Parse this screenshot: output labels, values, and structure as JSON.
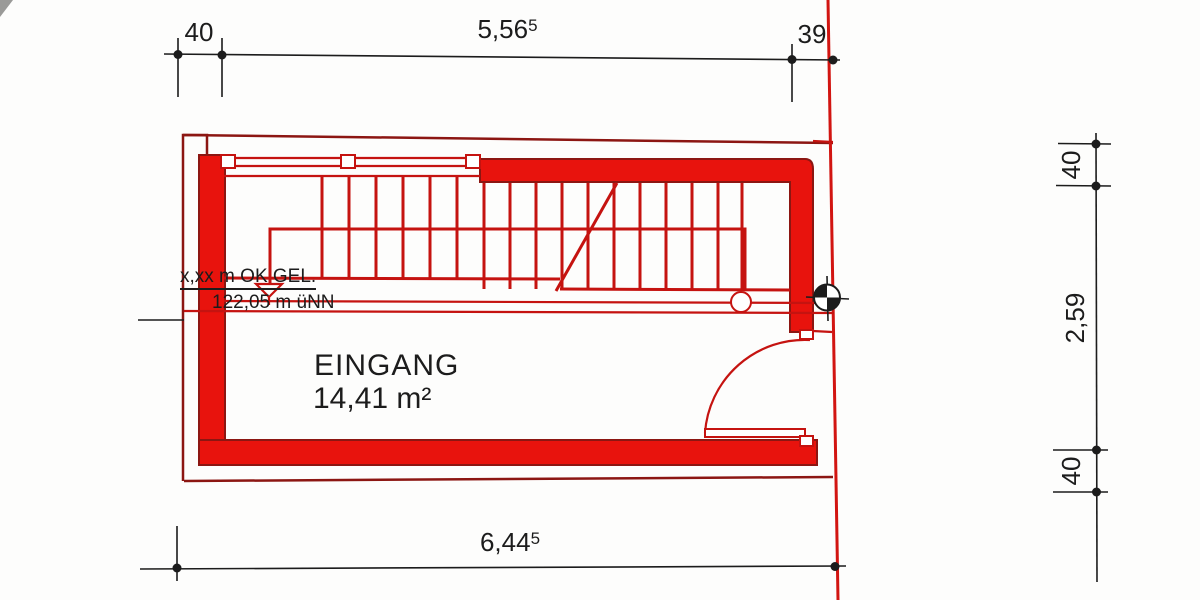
{
  "dimensions": {
    "top_left": "40",
    "top_main": {
      "value": "5,56",
      "sup": "5"
    },
    "top_right": "39",
    "bottom_main": {
      "value": "6,44",
      "sup": "5"
    },
    "right_top": "40",
    "right_middle": "2,59",
    "right_bottom": "40"
  },
  "room": {
    "name": "EINGANG",
    "area": "14,41 m²"
  },
  "elevation_note": {
    "line1": "x,xx m OK GEL.",
    "line2": "122,05 m üNN"
  },
  "symbols": {
    "origin_marker": "crosshair-circle-quadrants",
    "elevation_marker": "inverted-open-triangle",
    "column_marker": "open-circle",
    "door_swing": "quarter-arc"
  },
  "colors": {
    "wall_fill": "#e8130d",
    "line_red": "#c51310",
    "dark_red": "#8c1612",
    "boundary_red": "#d21511",
    "ink": "#1c1c1c",
    "paper": "#fdfdfc"
  }
}
